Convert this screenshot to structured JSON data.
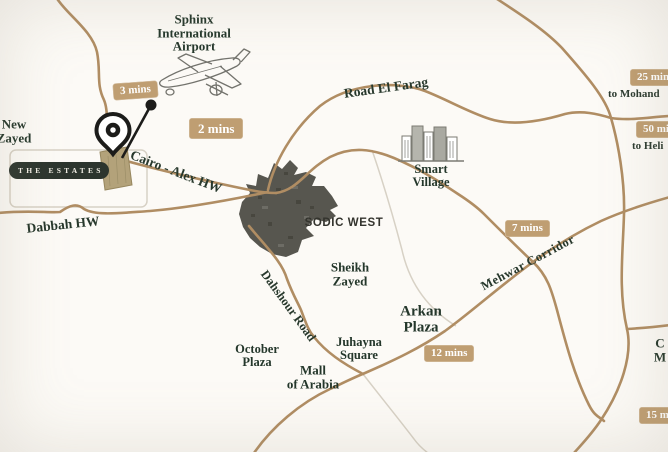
{
  "map": {
    "places": {
      "sphinx_airport": {
        "lines": [
          "Sphinx",
          "International",
          "Airport"
        ]
      },
      "new_zayed": {
        "lines": [
          "New",
          "Zayed"
        ]
      },
      "the_estates": {
        "label": "THE ESTATES"
      },
      "smart_village": {
        "lines": [
          "Smart",
          "Village"
        ]
      },
      "sodic_west": {
        "label": "SODIC WEST"
      },
      "sheikh_zayed": {
        "lines": [
          "Sheikh",
          "Zayed"
        ]
      },
      "arkan_plaza": {
        "lines": [
          "Arkan",
          "Plaza"
        ]
      },
      "juhayna_square": {
        "lines": [
          "Juhayna",
          "Square"
        ]
      },
      "october_plaza": {
        "lines": [
          "October",
          "Plaza"
        ]
      },
      "mall_of_arabia": {
        "lines": [
          "Mall",
          "of Arabia"
        ]
      },
      "partial_label_right_edge": {
        "lines": [
          "C",
          "M"
        ]
      }
    },
    "roads": {
      "cairo_alex_hw": "Cairo - Alex HW",
      "road_el_farag": "Road El Farag",
      "dabbah_hw": "Dabbah HW",
      "dahshour_road": "Dahshour Road",
      "mehwar_corridor": "Mehwar Corridor"
    },
    "travel_times": {
      "to_airport_road": "3 mins",
      "to_airport_hw": "2 mins",
      "mehwar_north": "7 mins",
      "mehwar_south": "12 mins",
      "right_top": "25 mins",
      "right_mid": "50 mins",
      "right_bottom": "15 mins"
    },
    "destinations": {
      "mohandessin_partial": "to Mohand",
      "heliopolis_partial": "to Heli"
    },
    "icons": [
      "map-pin-icon",
      "airplane-illustration",
      "buildings-illustration"
    ],
    "colors": {
      "background": "#fcfaf6",
      "road": "#b08d63",
      "road_light": "#d7d1c5",
      "badge_bg": "#bf9e72",
      "badge_text": "#ffffff",
      "label_text": "#24372b",
      "estates_badge_bg": "#2c352e",
      "developed_area": "#57564f",
      "pin": "#1c1c1a",
      "site_plot": "#b3a27a"
    }
  }
}
